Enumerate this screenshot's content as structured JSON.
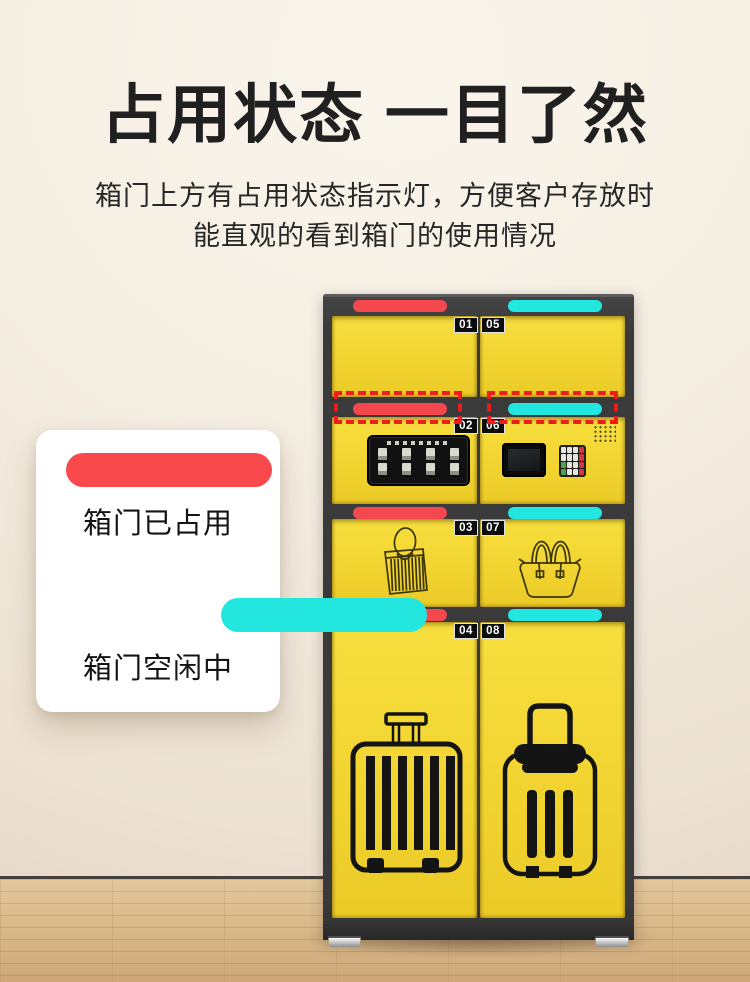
{
  "header": {
    "title": "占用状态 一目了然",
    "subtitle_line1": "箱门上方有占用状态指示灯，方便客户存放时",
    "subtitle_line2": "能直观的看到箱门的使用情况"
  },
  "legend": {
    "occupied": {
      "label": "箱门已占用",
      "color": "#f9494d"
    },
    "vacant": {
      "label": "箱门空闲中",
      "color": "#23e7de"
    }
  },
  "locker": {
    "rows": [
      {
        "left_no": "01",
        "right_no": "05",
        "left_status": "occupied",
        "right_status": "vacant"
      },
      {
        "left_no": "02",
        "right_no": "06",
        "left_status": "occupied",
        "right_status": "vacant"
      },
      {
        "left_no": "03",
        "right_no": "07",
        "left_status": "occupied",
        "right_status": "vacant"
      },
      {
        "left_no": "04",
        "right_no": "08",
        "left_status": "occupied",
        "right_status": "vacant"
      }
    ],
    "colors": {
      "door_yellow": "#f2d431",
      "frame_dark": "#3a3a3a",
      "indicator_occupied": "#f4484e",
      "indicator_vacant": "#22e7e0",
      "highlight_dashed": "#ee1c1c"
    }
  }
}
